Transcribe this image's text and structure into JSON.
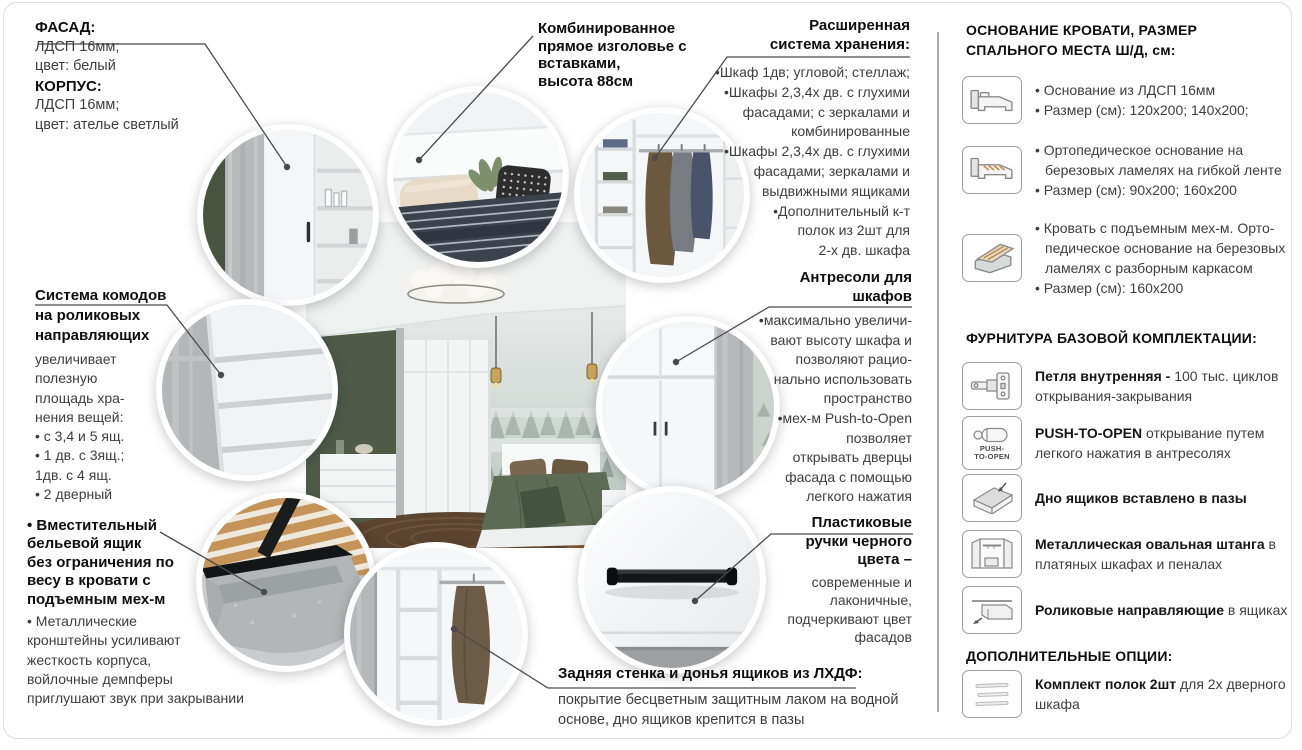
{
  "page": {
    "border_color": "#dedede",
    "divider_color": "#8f8f8f",
    "leader_color": "#4a4a4a",
    "heading_color": "#0e0e0e",
    "body_color": "#3d3d3d"
  },
  "callouts": {
    "facade": {
      "lines": [
        "ФАСАД:",
        "ЛДСП 16мм;",
        "цвет: белый",
        "КОРПУС:",
        "ЛДСП 16мм;",
        "цвет: ателье светлый"
      ]
    },
    "headboard": {
      "lines": [
        "Комбинированное",
        "прямое изголовье с",
        "вставками,",
        "высота 88см"
      ]
    },
    "storage": {
      "title_lines": [
        "Расширенная",
        "система хранения:"
      ],
      "lines": [
        "•Шкаф 1дв; угловой; стеллаж;",
        "•Шкафы 2,3,4х дв. с глухими",
        "фасадами; с зеркалами и",
        "комбинированные",
        "•Шкафы 2,3,4х дв. с глухими",
        "фасадами; зеркалами и",
        "выдвижными ящиками",
        "•Дополнительный к-т",
        "полок из 2шт для",
        "2-х дв. шкафа"
      ]
    },
    "drawers": {
      "title_lines": [
        "Система комодов",
        "на роликовых",
        "направляющих"
      ],
      "lines": [
        "увеличивает",
        "полезную",
        "площадь хра-",
        "нения вещей:",
        "• с 3,4 и 5 ящ.",
        "• 1 дв. с 3ящ.;",
        "1дв. с 4 ящ.",
        "• 2 дверный"
      ]
    },
    "mezzanine": {
      "title_lines": [
        "Антресоли для",
        "шкафов"
      ],
      "lines": [
        "•максимально увеличи-",
        "вают высоту шкафа и",
        "позволяют рацио-",
        "нально использовать",
        "пространство",
        "•мех-м Push-to-Open",
        "позволяет",
        "открывать дверцы",
        "фасада с помощью",
        "легкого нажатия"
      ]
    },
    "linen_box": {
      "title_lines": [
        "• Вместительный",
        "бельевой ящик",
        "без ограничения по",
        "весу в кровати с",
        "подъемным мех-м"
      ],
      "lines": [
        "• Металлические",
        "кронштейны усиливают",
        "жесткость корпуса,",
        "войлочные демпферы",
        "приглушают звук при закрывании"
      ]
    },
    "handles": {
      "title_lines": [
        "Пластиковые",
        "ручки черного",
        "цвета –"
      ],
      "lines": [
        "современные и",
        "лаконичные,",
        "подчеркивают цвет",
        "фасадов"
      ]
    },
    "back_wall": {
      "title": "Задняя стенка и донья ящиков из ЛХДФ:",
      "lines": [
        "покрытие бесцветным защитным лаком на водной",
        "основе, дно ящиков крепится в пазы"
      ]
    }
  },
  "sidebar": {
    "beds": {
      "title_lines": [
        "ОСНОВАНИЕ КРОВАТИ, РАЗМЕР",
        "СПАЛЬНОГО МЕСТА Ш/Д, см:"
      ],
      "items": [
        {
          "icon": "bed-base-icon",
          "bullets": [
            "• Основание из ЛДСП 16мм",
            "• Размер (см): 120x200; 140x200;"
          ]
        },
        {
          "icon": "bed-ortho-icon",
          "bullets": [
            "• Ортопедическое основание на березовых ламелях на гибкой ленте",
            "• Размер (см): 90x200; 160x200"
          ]
        },
        {
          "icon": "bed-lift-icon",
          "bullets": [
            "• Кровать с подъемным мех-м. Орто-педическое основание на березовых ламелях с разборным каркасом",
            "• Размер (см): 160x200"
          ]
        }
      ]
    },
    "hardware": {
      "title": "ФУРНИТУРА БАЗОВОЙ КОМПЛЕКТАЦИИ:",
      "items": [
        {
          "icon": "hinge-icon",
          "bold": "Петля внутренняя -",
          "rest": " 100 тыс. циклов открывания-закрывания"
        },
        {
          "icon": "push-to-open-icon",
          "icon_caption_lines": [
            "PUSH-",
            "TO-OPEN"
          ],
          "bold": "PUSH-TO-OPEN",
          "rest": " открывание путем легкого нажатия в антресолях"
        },
        {
          "icon": "drawer-bottom-icon",
          "bold": "Дно ящиков вставлено в пазы",
          "rest": ""
        },
        {
          "icon": "wardrobe-rod-icon",
          "bold": "Металлическая овальная штанга",
          "rest": " в платяных шкафах и пеналах"
        },
        {
          "icon": "roller-guides-icon",
          "bold": "Роликовые направляющие",
          "rest": " в ящиках"
        }
      ]
    },
    "options": {
      "title": "ДОПОЛНИТЕЛЬНЫЕ ОПЦИИ:",
      "items": [
        {
          "icon": "shelf-kit-icon",
          "bold": "Комплект полок 2шт",
          "rest": " для 2х дверного шкафа"
        }
      ]
    }
  }
}
